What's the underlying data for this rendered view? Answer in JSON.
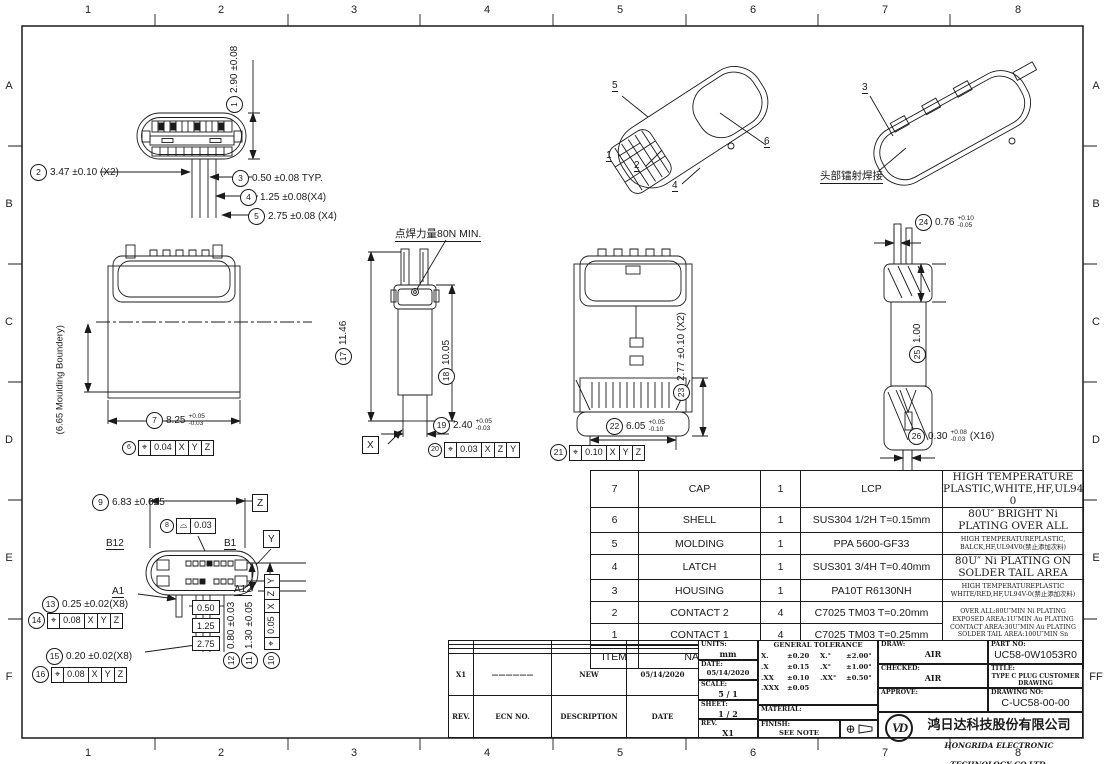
{
  "border": {
    "cols": [
      "1",
      "2",
      "3",
      "4",
      "5",
      "6",
      "7",
      "8"
    ],
    "rows_left": [
      "A",
      "B",
      "C",
      "D",
      "E",
      "F"
    ],
    "rows_right": [
      "A",
      "B",
      "C",
      "D",
      "E",
      "FF"
    ]
  },
  "notes": {
    "spot_weld": "点焊力量80N MIN.",
    "laser_weld": "头部镭射焊接",
    "moulding": "(6.65 Moulding Boundery)"
  },
  "datums": {
    "x": "X",
    "y": "Y",
    "z": "Z"
  },
  "pins": {
    "b12": "B12",
    "b1": "B1",
    "a1": "A1",
    "a12": "A12"
  },
  "balloons": {
    "iso_left": [
      "5",
      "1",
      "2",
      "4",
      "6"
    ],
    "iso_right": [
      "3"
    ]
  },
  "dims": {
    "d1": {
      "n": "1",
      "text": "2.90 ±0.08"
    },
    "d2": {
      "n": "2",
      "text": "3.47 ±0.10 (X2)"
    },
    "d3": {
      "n": "3",
      "text": "0.50 ±0.08  TYP."
    },
    "d4": {
      "n": "4",
      "text": "1.25 ±0.08(X4)"
    },
    "d5": {
      "n": "5",
      "text": "2.75 ±0.08 (X4)"
    },
    "d6": {
      "n": "6",
      "sym": "⌖",
      "tol": "0.04",
      "r1": "X",
      "r2": "Y",
      "r3": "Z"
    },
    "d7": {
      "n": "7",
      "text": "8.25",
      "up": "+0.05",
      "dn": "-0.03"
    },
    "d8": {
      "n": "8",
      "sym": "⌓",
      "tol": "0.03"
    },
    "d9": {
      "n": "9",
      "text": "6.83 ±0.025"
    },
    "d10": {
      "n": "10",
      "sym": "⌖",
      "tol": "0.05",
      "r1": "X",
      "r2": "Z",
      "r3": "Y"
    },
    "d11": {
      "n": "11",
      "text": "1.30 ±0.05"
    },
    "d12": {
      "n": "12",
      "text": "0.80 ±0.03"
    },
    "d13": {
      "n": "13",
      "text": "0.25 ±0.02(X8)"
    },
    "d14": {
      "n": "14",
      "sym": "⌖",
      "tol": "0.08",
      "r1": "X",
      "r2": "Y",
      "r3": "Z"
    },
    "d15": {
      "n": "15",
      "text": "0.20 ±0.02(X8)"
    },
    "d16": {
      "n": "16",
      "sym": "⌖",
      "tol": "0.08",
      "r1": "X",
      "r2": "Y",
      "r3": "Z"
    },
    "d17": {
      "n": "17",
      "text": "11.46"
    },
    "d18": {
      "n": "18",
      "text": "10.05"
    },
    "d19": {
      "n": "19",
      "text": "2.40",
      "up": "+0.05",
      "dn": "-0.03"
    },
    "d20": {
      "n": "20",
      "sym": "⌖",
      "tol": "0.03",
      "r1": "X",
      "r2": "Z",
      "r3": "Y"
    },
    "d21": {
      "n": "21",
      "sym": "⌖",
      "tol": "0.10",
      "r1": "X",
      "r2": "Y",
      "r3": "Z"
    },
    "d22": {
      "n": "22",
      "text": "6.05",
      "up": "+0.05",
      "dn": "-0.10"
    },
    "d23": {
      "n": "23",
      "text": "2.77 ±0.10 (X2)"
    },
    "d24": {
      "n": "24",
      "text": "0.76",
      "up": "+0.10",
      "dn": "-0.05"
    },
    "d25": {
      "n": "25",
      "text": "1.00"
    },
    "d26": {
      "n": "26",
      "text": "0.30",
      "up": "+0.08",
      "dn": "-0.03",
      "suffix": "(X16)"
    },
    "basic": [
      "0.50",
      "1.25",
      "2.75"
    ]
  },
  "bom": {
    "headers": {
      "item": "ITEM",
      "name": "NAME",
      "qty": "Q'TY",
      "material": "MATERIAC",
      "finished": "FINISHED"
    },
    "rows": [
      {
        "item": "7",
        "name": "CAP",
        "qty": "1",
        "material": "LCP",
        "finished": "HIGH TEMPERATURE PLASTIC,WHITE,HF,UL94V-0"
      },
      {
        "item": "6",
        "name": "SHELL",
        "qty": "1",
        "material": "SUS304 1/2H T=0.15mm",
        "finished": "80U″ BRIGHT Ni PLATING OVER ALL"
      },
      {
        "item": "5",
        "name": "MOLDING",
        "qty": "1",
        "material": "PPA 5600-GF33",
        "finished": "HIGH TEMPERATUREPLASTIC,\nBALCK,HF,UL94V0(禁止添加次料)"
      },
      {
        "item": "4",
        "name": "LATCH",
        "qty": "1",
        "material": "SUS301 3/4H T=0.40mm",
        "finished": "80U″ Ni PLATING ON SOLDER TAIL AREA"
      },
      {
        "item": "3",
        "name": "HOUSING",
        "qty": "1",
        "material": "PA10T  R6130NH",
        "finished": "HIGH TEMPERATUREPLASTIC\nWHITE/RED,HF,UL94V-0(禁止添加次料)"
      },
      {
        "item": "2",
        "name": "CONTACT 2",
        "qty": "4",
        "material": "C7025 TM03 T=0.20mm"
      },
      {
        "item": "1",
        "name": "CONTACT 1",
        "qty": "4",
        "material": "C7025 TM03 T=0.25mm"
      }
    ],
    "contacts_finished": "OVER ALL:80U″MIN Ni PLATING\nEXPOSED AREA:1U″MIN Au PLATING\nCONTACT AREA:30U″MIN  Au PLATING\nSOLDER TAIL AREA:100U″MIN Sn"
  },
  "rev_table": {
    "headers": [
      "REV.",
      "ECN NO.",
      "DESCRIPTION",
      "DATE"
    ],
    "row": {
      "rev": "X1",
      "ecn": "——————",
      "desc": "NEW",
      "date": "05/14/2020"
    }
  },
  "title_block": {
    "units_label": "UNITS:",
    "units": "mm",
    "date_label": "DATE:",
    "date": "05/14/2020",
    "scale_label": "SCALE:",
    "scale": "5 / 1",
    "sheet_label": "SHEET:",
    "sheet": "1 / 2",
    "rev_label": "REV.",
    "rev": "X1",
    "tol_title": "GENERAL TOLERANCE",
    "tol": [
      [
        "X.",
        "±0.20",
        "X.°",
        "±2.00°"
      ],
      [
        ".X",
        "±0.15",
        ".X°",
        "±1.00°"
      ],
      [
        ".XX",
        "±0.10",
        ".XX°",
        "±0.50°"
      ],
      [
        ".XXX",
        "±0.05",
        "",
        ""
      ]
    ],
    "material_label": "MATERIAL:",
    "finish_label": "FINISH:",
    "finish": "SEE NOTE",
    "draw_label": "DRAW:",
    "draw": "AIR",
    "checked_label": "CHECKED:",
    "checked": "AIR",
    "approve_label": "APPROVE:",
    "part_no_label": "PART NO:",
    "part_no": "UC58-0W1053R0",
    "title_label": "TITLE:",
    "title": "TYPE C PLUG CUSTOMER DRAWING",
    "drawing_no_label": "DRAWING NO:",
    "drawing_no": "C-UC58-00-00",
    "company_cn": "鸿日达科技股份有限公司",
    "company_en": "HONGRIDA ELECTRONIC TECHNOLOGY CO,LTD.",
    "logo_text": "VD",
    "projection_target": "⊕"
  }
}
